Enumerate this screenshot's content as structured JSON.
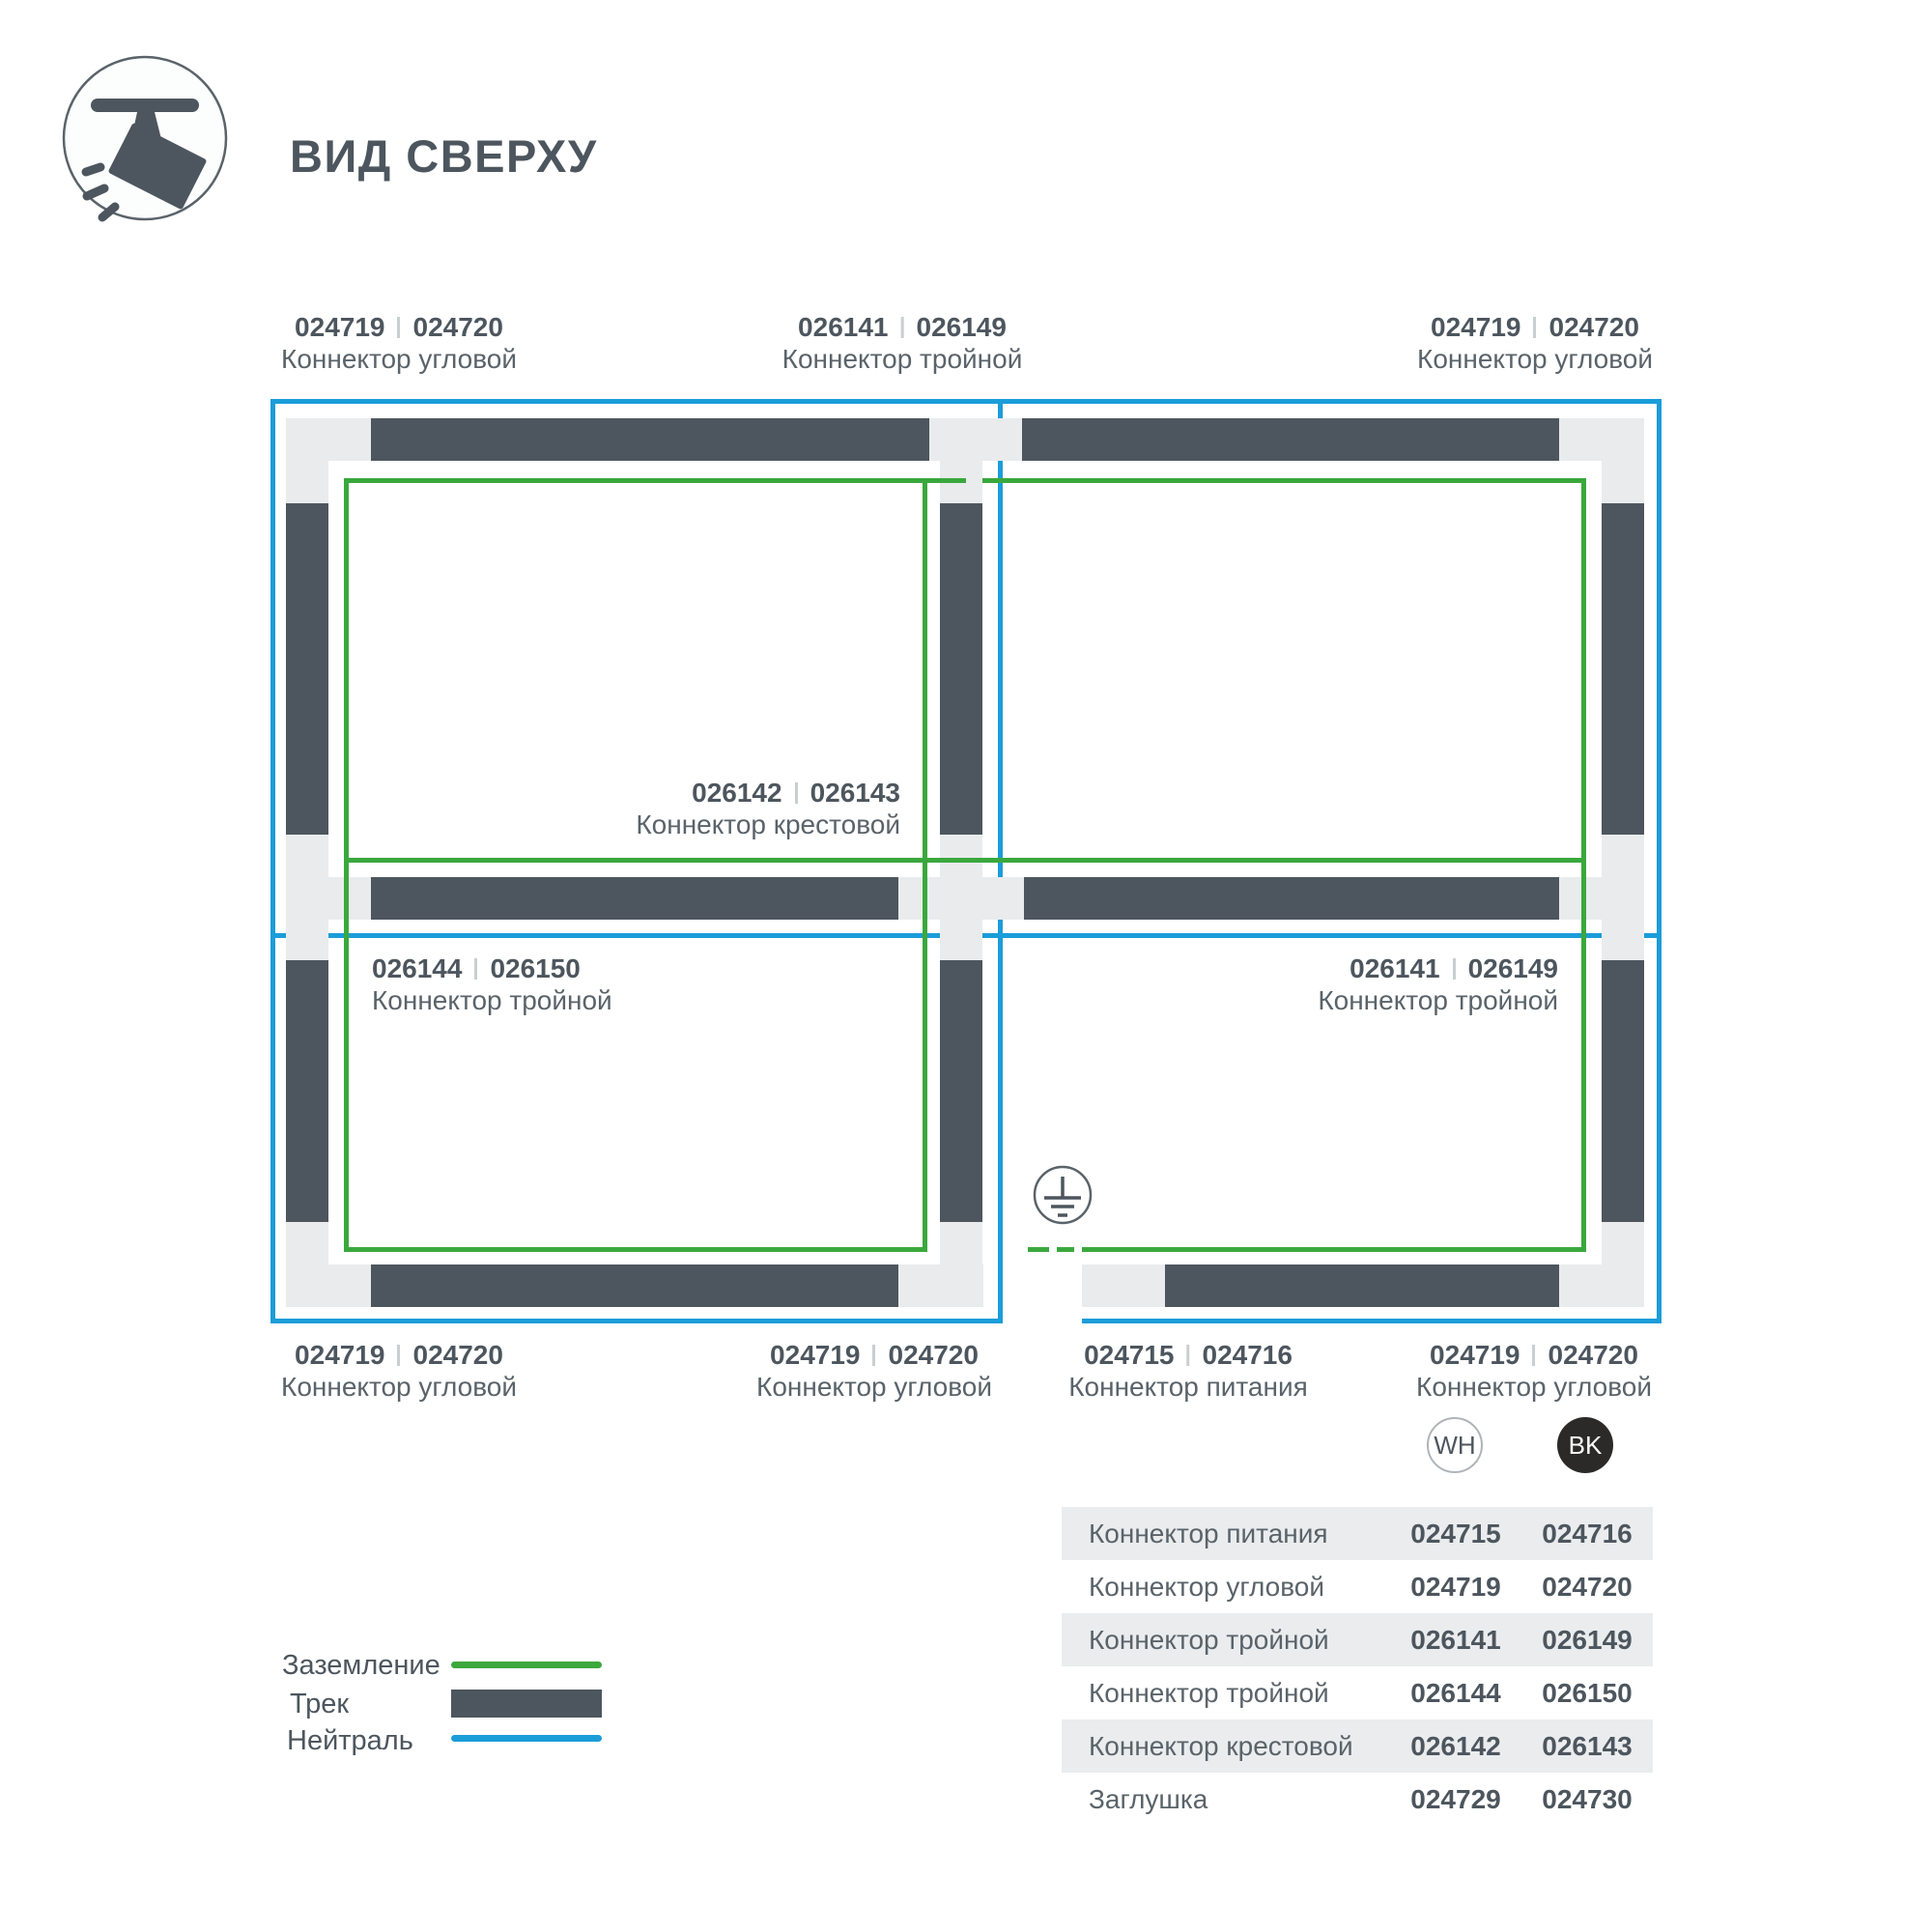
{
  "header": {
    "title": "ВИД СВЕРХУ",
    "icon": "track-spotlight-icon"
  },
  "labels": {
    "top_left": {
      "code_wh": "024719",
      "code_bk": "024720",
      "name": "Коннектор угловой"
    },
    "top_mid": {
      "code_wh": "026141",
      "code_bk": "026149",
      "name": "Коннектор тройной"
    },
    "top_right": {
      "code_wh": "024719",
      "code_bk": "024720",
      "name": "Коннектор угловой"
    },
    "center": {
      "code_wh": "026142",
      "code_bk": "026143",
      "name": "Коннектор крестовой"
    },
    "mid_left": {
      "code_wh": "026144",
      "code_bk": "026150",
      "name": "Коннектор тройной"
    },
    "mid_right": {
      "code_wh": "026141",
      "code_bk": "026149",
      "name": "Коннектор тройной"
    },
    "bottom_left": {
      "code_wh": "024719",
      "code_bk": "024720",
      "name": "Коннектор угловой"
    },
    "bottom_mid": {
      "code_wh": "024719",
      "code_bk": "024720",
      "name": "Коннектор угловой"
    },
    "bottom_feed": {
      "code_wh": "024715",
      "code_bk": "024716",
      "name": "Коннектор питания"
    },
    "bottom_right": {
      "code_wh": "024719",
      "code_bk": "024720",
      "name": "Коннектор угловой"
    }
  },
  "legend": {
    "ground": {
      "label": "Заземление"
    },
    "track": {
      "label": "Трек"
    },
    "neutral": {
      "label": "Нейтраль"
    }
  },
  "table": {
    "col_wh": "WH",
    "col_bk": "BK",
    "rows": [
      {
        "name": "Коннектор питания",
        "wh": "024715",
        "bk": "024716"
      },
      {
        "name": "Коннектор угловой",
        "wh": "024719",
        "bk": "024720"
      },
      {
        "name": "Коннектор тройной",
        "wh": "026141",
        "bk": "026149"
      },
      {
        "name": "Коннектор тройной",
        "wh": "026144",
        "bk": "026150"
      },
      {
        "name": "Коннектор крестовой",
        "wh": "026142",
        "bk": "026143"
      },
      {
        "name": "Заглушка",
        "wh": "024729",
        "bk": "024730"
      }
    ]
  },
  "colors": {
    "ground": "#3aa83d",
    "neutral": "#1b9dd9",
    "track": "#4d565e",
    "connector": "#e9ebec",
    "text_dark": "#4d565e",
    "text_soft": "#5a636a",
    "row_stripe": "#eaecee",
    "bk_badge": "#2b2a29"
  }
}
